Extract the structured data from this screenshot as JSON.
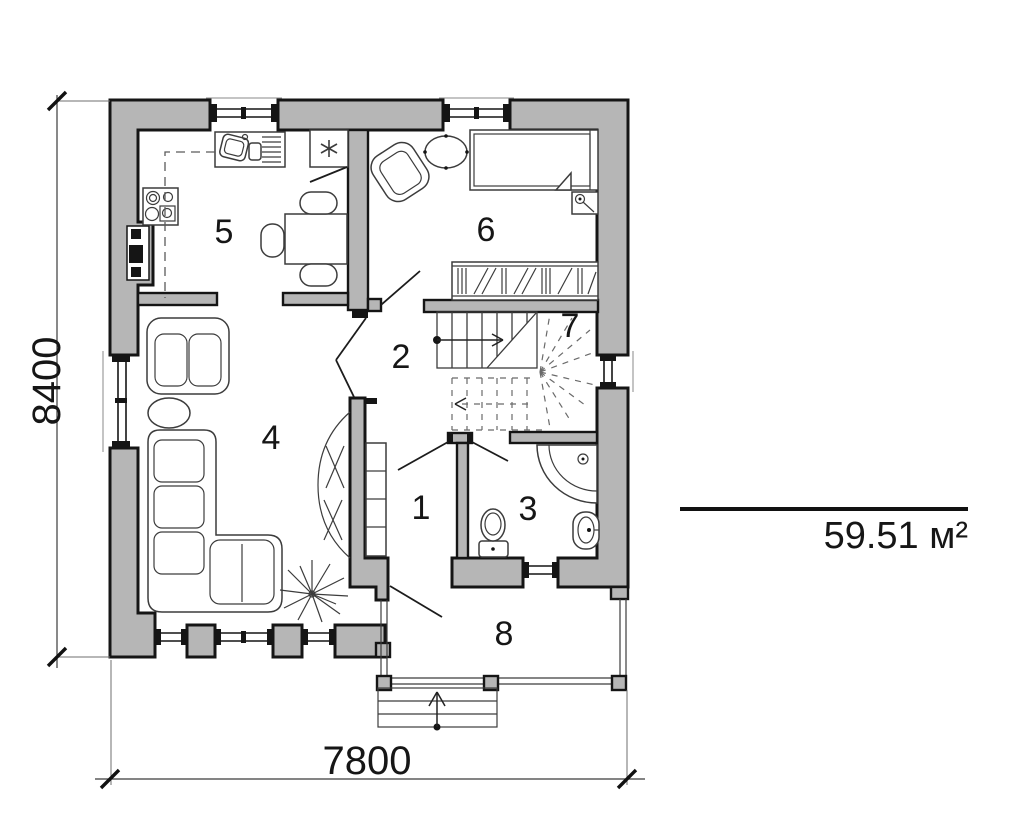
{
  "plan": {
    "area_label": "59.51 м²",
    "width_label": "7800",
    "height_label": "8400",
    "rooms": [
      {
        "label": "1"
      },
      {
        "label": "2"
      },
      {
        "label": "3"
      },
      {
        "label": "4"
      },
      {
        "label": "5"
      },
      {
        "label": "6"
      },
      {
        "label": "7"
      },
      {
        "label": "8"
      }
    ]
  }
}
